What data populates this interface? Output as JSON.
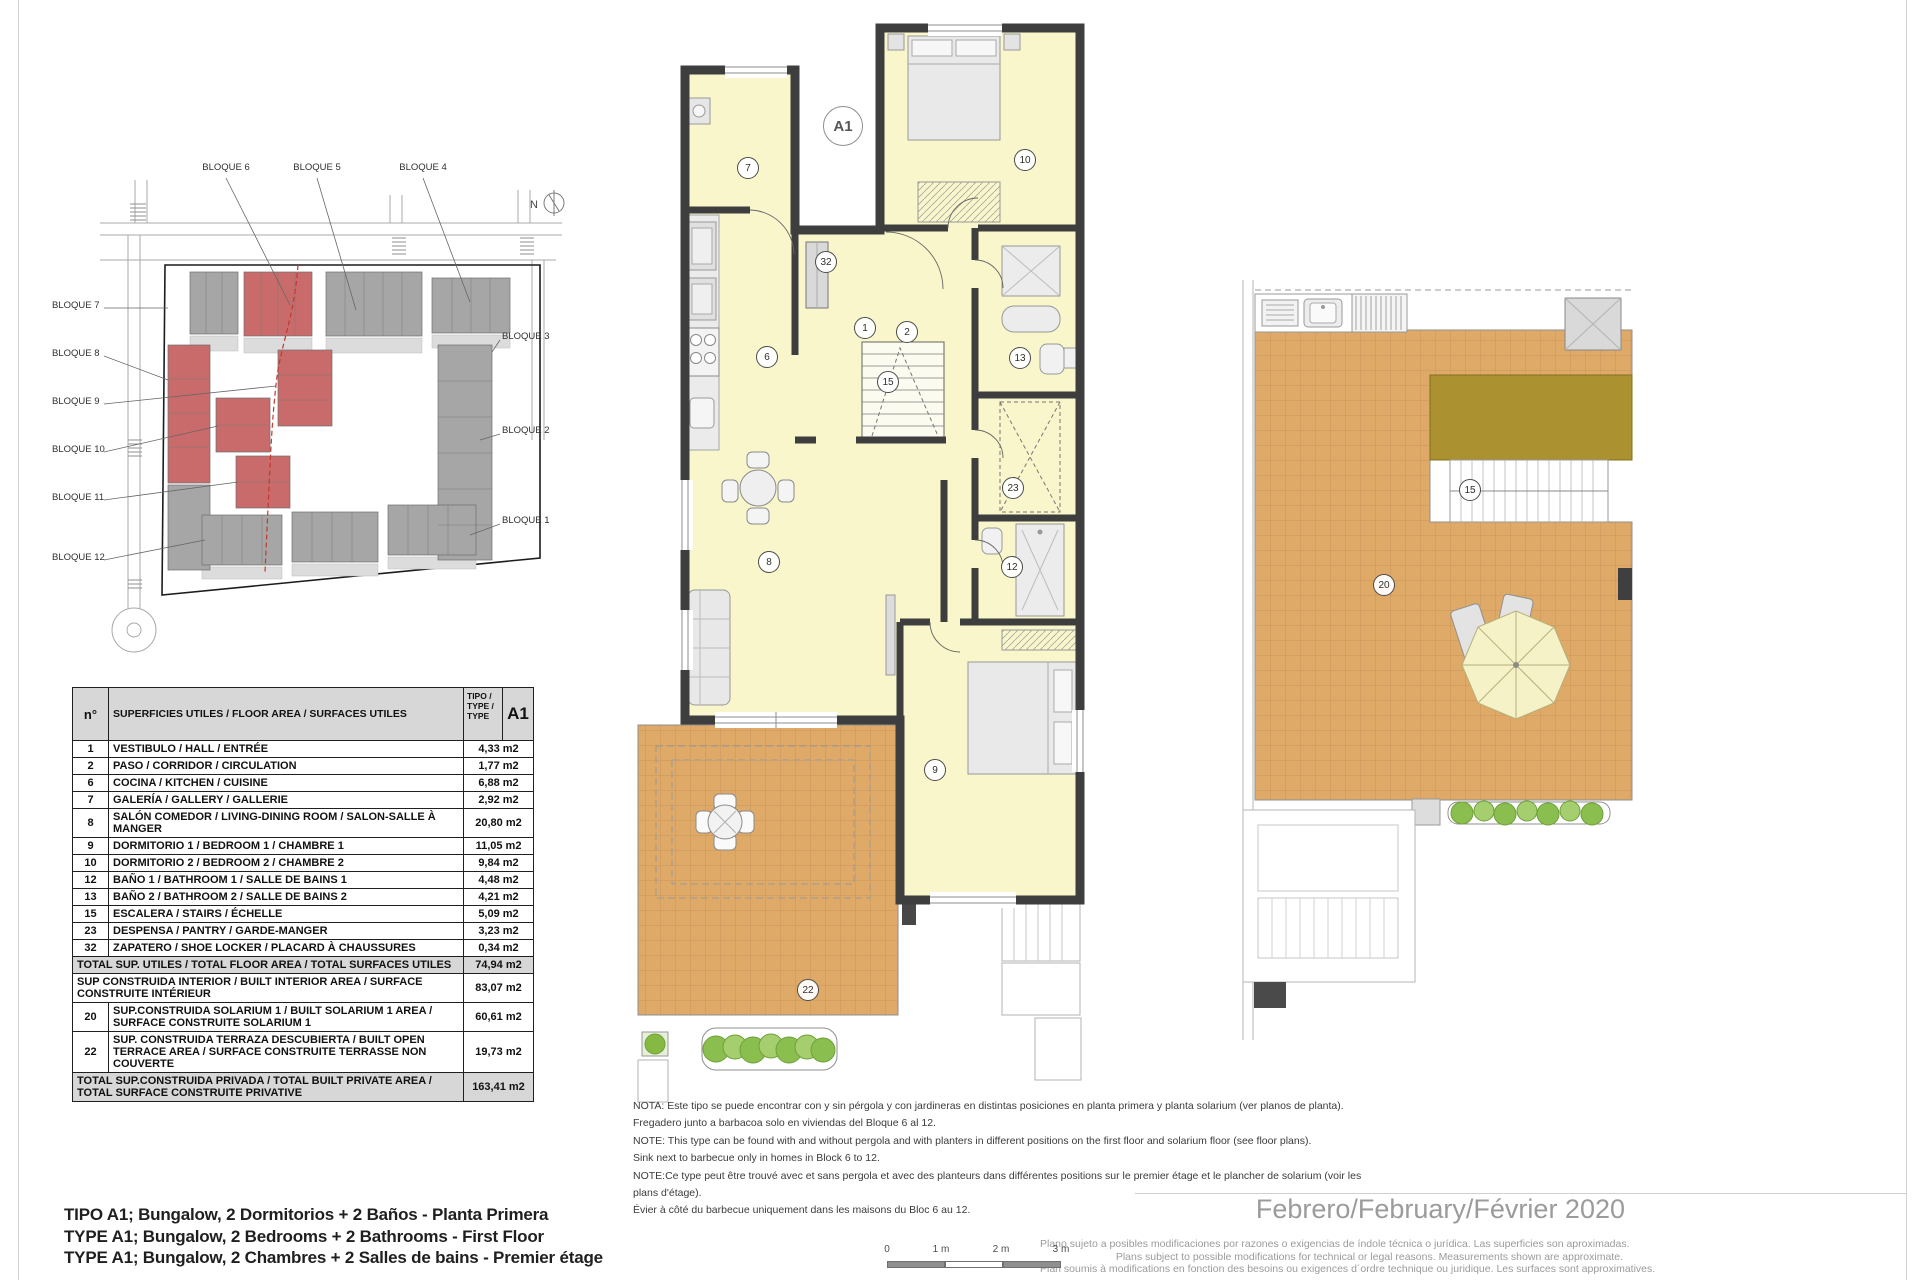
{
  "colors": {
    "wall": "#3e3e3e",
    "room_fill": "#f8f6ca",
    "terrace": "#dfa967",
    "pergola": "#ac9130",
    "block_red": "#c96b6b",
    "block_gray": "#a6a6a6",
    "table_header_bg": "#d7d7d7",
    "footer_gray": "#9b9b9b"
  },
  "site_plan": {
    "north_label": "N",
    "top_labels": [
      "BLOQUE 6",
      "BLOQUE 5",
      "BLOQUE 4"
    ],
    "left_labels": [
      "BLOQUE 7",
      "BLOQUE 8",
      "BLOQUE 9",
      "BLOQUE 10",
      "BLOQUE 11",
      "BLOQUE 12"
    ],
    "right_labels": [
      "BLOQUE 3",
      "BLOQUE 2",
      "BLOQUE 1"
    ]
  },
  "area_table": {
    "header": {
      "num": "n°",
      "desc": "SUPERFICIES UTILES / FLOOR AREA / SURFACES UTILES",
      "tipo": "TIPO /\nTYPE /\nTYPE",
      "code": "A1"
    },
    "rows": [
      {
        "num": "1",
        "desc": "VESTIBULO / HALL / ENTRÉE",
        "value": "4,33 m2",
        "shaded": false
      },
      {
        "num": "2",
        "desc": "PASO / CORRIDOR / CIRCULATION",
        "value": "1,77 m2",
        "shaded": false
      },
      {
        "num": "6",
        "desc": "COCINA / KITCHEN / CUISINE",
        "value": "6,88 m2",
        "shaded": false
      },
      {
        "num": "7",
        "desc": "GALERÍA / GALLERY / GALLERIE",
        "value": "2,92 m2",
        "shaded": false
      },
      {
        "num": "8",
        "desc": "SALÓN COMEDOR  / LIVING-DINING ROOM / SALON-SALLE À MANGER",
        "value": "20,80 m2",
        "shaded": false
      },
      {
        "num": "9",
        "desc": "DORMITORIO 1 / BEDROOM 1 / CHAMBRE 1",
        "value": "11,05 m2",
        "shaded": false
      },
      {
        "num": "10",
        "desc": "DORMITORIO 2 / BEDROOM 2 / CHAMBRE 2",
        "value": "9,84 m2",
        "shaded": false
      },
      {
        "num": "12",
        "desc": "BAÑO 1 / BATHROOM 1 / SALLE DE BAINS 1",
        "value": "4,48 m2",
        "shaded": false
      },
      {
        "num": "13",
        "desc": "BAÑO 2 / BATHROOM 2 / SALLE DE BAINS 2",
        "value": "4,21 m2",
        "shaded": false
      },
      {
        "num": "15",
        "desc": "ESCALERA / STAIRS / ÉCHELLE",
        "value": "5,09 m2",
        "shaded": false
      },
      {
        "num": "23",
        "desc": "DESPENSA / PANTRY / GARDE-MANGER",
        "value": "3,23 m2",
        "shaded": false
      },
      {
        "num": "32",
        "desc": "ZAPATERO / SHOE LOCKER / PLACARD À CHAUSSURES",
        "value": "0,34 m2",
        "shaded": false
      },
      {
        "num": null,
        "desc": "TOTAL SUP. UTILES / TOTAL FLOOR AREA / TOTAL SURFACES UTILES",
        "value": "74,94 m2",
        "shaded": true
      },
      {
        "num": null,
        "desc": "SUP CONSTRUIDA INTERIOR / BUILT INTERIOR AREA / SURFACE CONSTRUITE INTÉRIEUR",
        "value": "83,07 m2",
        "shaded": false
      },
      {
        "num": "20",
        "desc": "SUP.CONSTRUIDA SOLARIUM 1 / BUILT SOLARIUM 1 AREA / SURFACE CONSTRUITE SOLARIUM 1",
        "value": "60,61 m2",
        "shaded": false
      },
      {
        "num": "22",
        "desc": "SUP. CONSTRUIDA TERRAZA DESCUBIERTA / BUILT OPEN TERRACE AREA / SURFACE CONSTRUITE TERRASSE NON COUVERTE",
        "value": "19,73 m2",
        "shaded": false
      },
      {
        "num": null,
        "desc": "TOTAL SUP.CONSTRUIDA PRIVADA / TOTAL  BUILT PRIVATE AREA / TOTAL SURFACE CONSTRUITE PRIVATIVE",
        "value": "163,41 m2",
        "shaded": true
      }
    ]
  },
  "floor_plan": {
    "unit_badge": "A1",
    "rooms": [
      {
        "n": "7"
      },
      {
        "n": "10"
      },
      {
        "n": "32"
      },
      {
        "n": "1"
      },
      {
        "n": "2"
      },
      {
        "n": "13"
      },
      {
        "n": "6"
      },
      {
        "n": "15"
      },
      {
        "n": "23"
      },
      {
        "n": "12"
      },
      {
        "n": "8"
      },
      {
        "n": "9"
      },
      {
        "n": "22"
      }
    ]
  },
  "solarium_plan": {
    "rooms": [
      {
        "n": "15"
      },
      {
        "n": "20"
      }
    ]
  },
  "notes": {
    "lines": [
      "NOTA: Este tipo se puede encontrar con y sin pérgola y con jardineras en distintas posiciones en planta primera y planta solarium (ver planos de planta).",
      "Fregadero junto a barbacoa solo en viviendas del Bloque 6 al 12.",
      "NOTE: This type can be found with and without pergola and with planters in different positions on the first floor and solarium floor (see floor plans).",
      "Sink next to barbecue only in homes in Block 6 to 12.",
      "NOTE:Ce type peut être trouvé avec et sans pergola et avec des planteurs dans différentes positions sur le premier étage et le plancher de solarium (voir les",
      "plans d'étage).",
      "Évier à côté du barbecue uniquement dans les maisons du Bloc 6 au 12."
    ]
  },
  "titles": {
    "lines": [
      "TIPO A1; Bungalow, 2 Dormitorios + 2 Baños - Planta Primera",
      "TYPE A1; Bungalow, 2 Bedrooms + 2 Bathrooms - First Floor",
      "TYPE A1; Bungalow, 2 Chambres + 2 Salles de bains - Premier étage"
    ]
  },
  "footer": {
    "date": "Febrero/February/Février 2020",
    "disclaimer": [
      "Plano sujeto a posibles modificaciones por razones o exigencias de índole técnica o jurídica. Las superficies son aproximadas.",
      "Plans subject to possible modifications for technical or legal reasons. Measurements shown are approximate.",
      "Plan soumis à modifications en fonction des besoins ou exigences d´ordre technique ou juridique. Les surfaces sont approximatives."
    ]
  },
  "scale_bar": {
    "labels": [
      "0",
      "1 m",
      "2 m",
      "3 m"
    ]
  }
}
